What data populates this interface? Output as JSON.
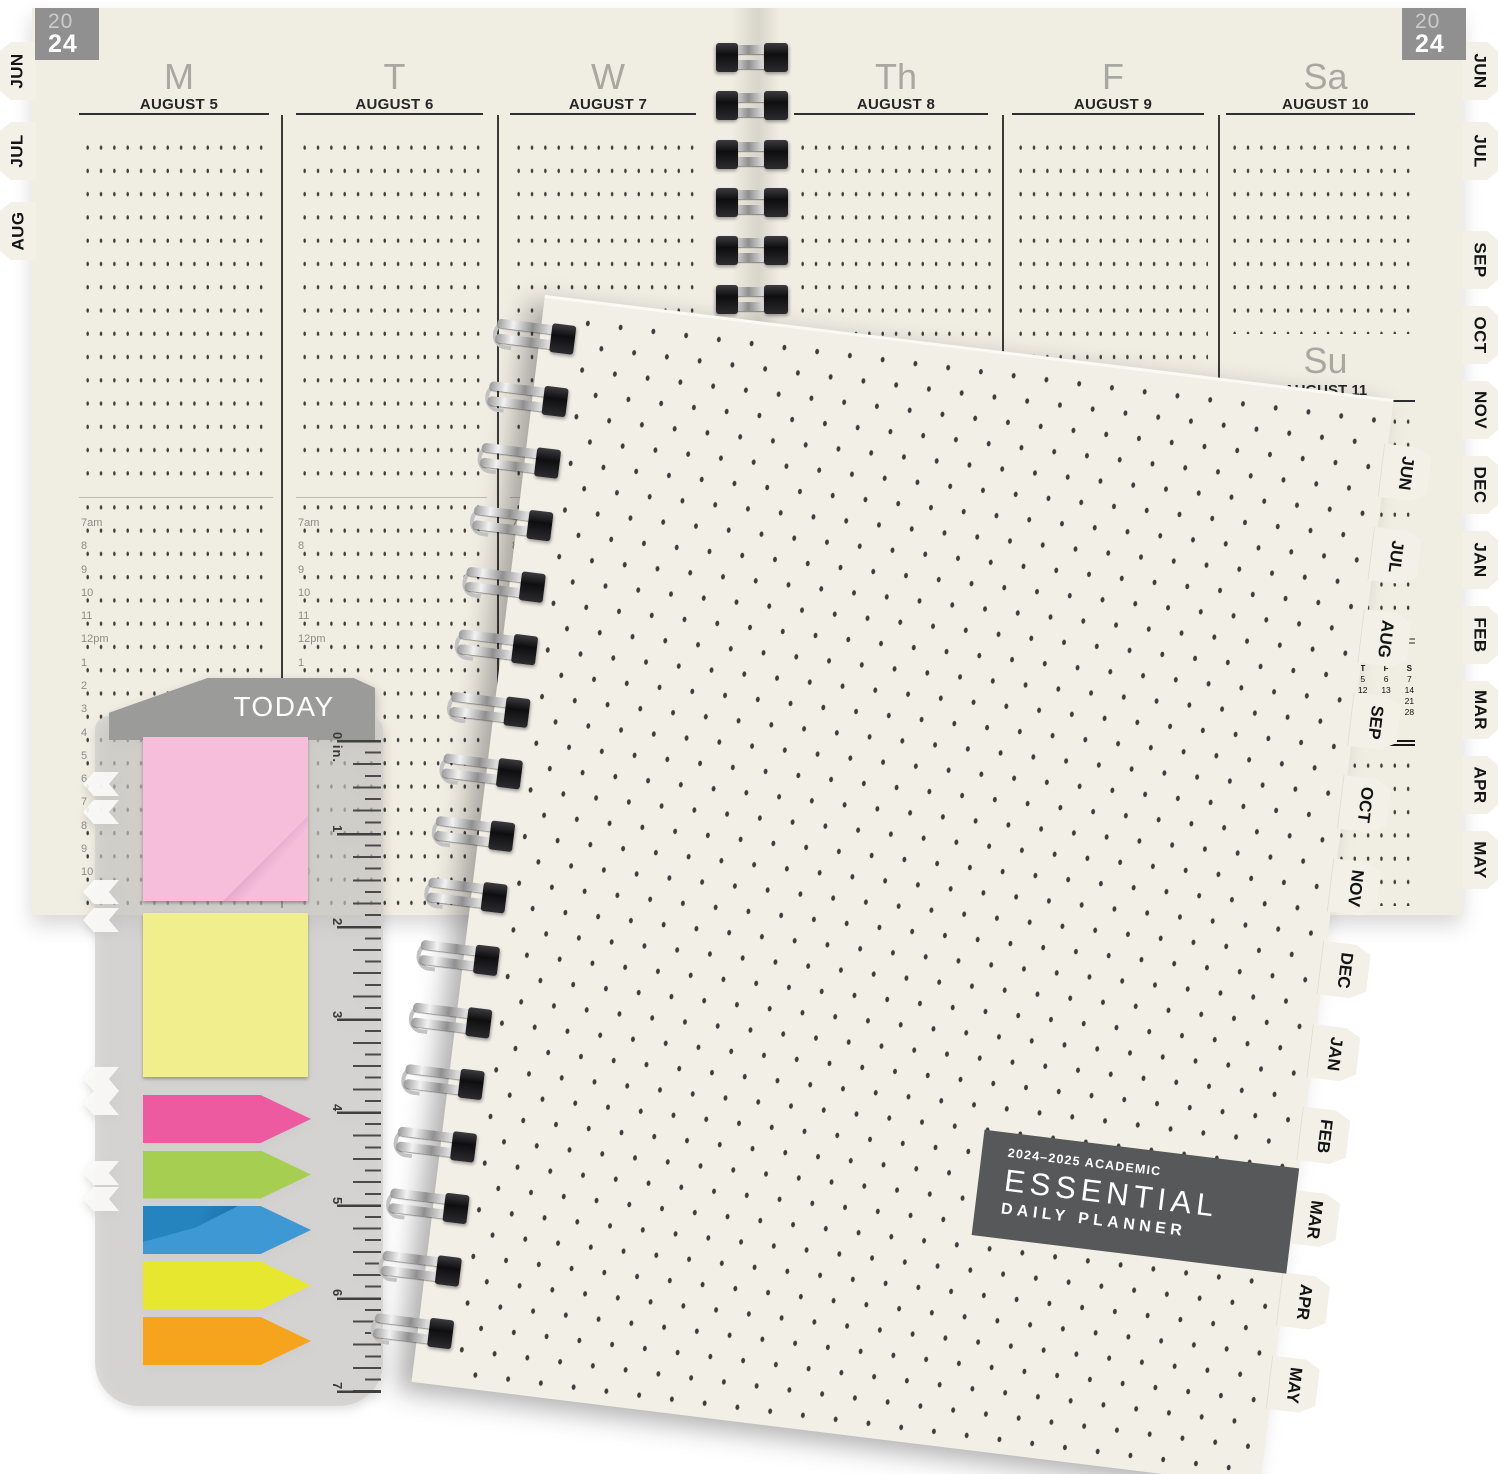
{
  "product": {
    "year_badge": {
      "line1": "20",
      "line2": "24"
    }
  },
  "planner_week": {
    "days": [
      {
        "letter": "M",
        "date": "AUGUST 5"
      },
      {
        "letter": "T",
        "date": "AUGUST 6"
      },
      {
        "letter": "W",
        "date": "AUGUST 7"
      },
      {
        "letter": "Th",
        "date": "AUGUST 8"
      },
      {
        "letter": "F",
        "date": "AUGUST 9"
      },
      {
        "letter": "Sa",
        "date": "AUGUST 10"
      }
    ],
    "sunday": {
      "letter": "Su",
      "date": "AUGUST 11"
    },
    "time_labels": [
      "7am",
      "8",
      "9",
      "10",
      "11",
      "12pm",
      "1",
      "2",
      "3",
      "4",
      "5",
      "6",
      "7",
      "8",
      "9",
      "10"
    ],
    "left_tabs": [
      "JUN",
      "JUL",
      "AUG"
    ],
    "right_tabs_top": [
      "JUN",
      "JUL"
    ],
    "right_tabs_bottom": [
      "SEP",
      "OCT",
      "NOV",
      "DEC",
      "JAN",
      "FEB",
      "MAR",
      "APR",
      "MAY"
    ],
    "mini_calendar": {
      "title": "SEPTEMBER 2024",
      "weekdays": [
        "S",
        "M",
        "T",
        "W",
        "T",
        "F",
        "S"
      ],
      "cells": [
        "1",
        "2",
        "3",
        "4",
        "5",
        "6",
        "7",
        "8",
        "9",
        "10",
        "11",
        "12",
        "13",
        "14",
        "15",
        "16",
        "17",
        "18",
        "19",
        "20",
        "21",
        "22",
        "23",
        "24",
        "25",
        "26",
        "27",
        "28",
        "29",
        "30",
        "",
        "",
        "",
        "",
        ""
      ]
    }
  },
  "cover": {
    "label_line1": "2024–2025 ACADEMIC",
    "label_line2": "ESSENTIAL",
    "label_line3": "DAILY PLANNER",
    "tabs": [
      "JUN",
      "JUL",
      "AUG",
      "SEP",
      "OCT",
      "NOV",
      "DEC",
      "JAN",
      "FEB",
      "MAR",
      "APR",
      "MAY"
    ]
  },
  "bookmark": {
    "title": "TODAY",
    "ruler_numbers": [
      "0 in.",
      "1",
      "2",
      "3",
      "4",
      "5",
      "6",
      "7"
    ],
    "stickies": [
      {
        "name": "pink sticky note",
        "color": "#f6bedb"
      },
      {
        "name": "yellow sticky note",
        "color": "#f1ee8e"
      }
    ],
    "flags": [
      {
        "name": "pink flag",
        "color": "#ee5aa0"
      },
      {
        "name": "green flag",
        "color": "#a6cf52"
      },
      {
        "name": "blue flag",
        "color": "#3e98d4"
      },
      {
        "name": "yellow flag",
        "color": "#e7e72f"
      },
      {
        "name": "orange flag",
        "color": "#f6a41e"
      }
    ]
  },
  "colors": {
    "page_cream": "#f0ede3",
    "cover_cream": "#f2efe7",
    "cover_label_bg": "#57585a",
    "year_badge_bg": "#909090",
    "bookmark_header": "#9b9b99",
    "tab_bg": "#f2f0e7",
    "day_letter_gray": "#a9a7a2",
    "date_text": "#262626"
  }
}
